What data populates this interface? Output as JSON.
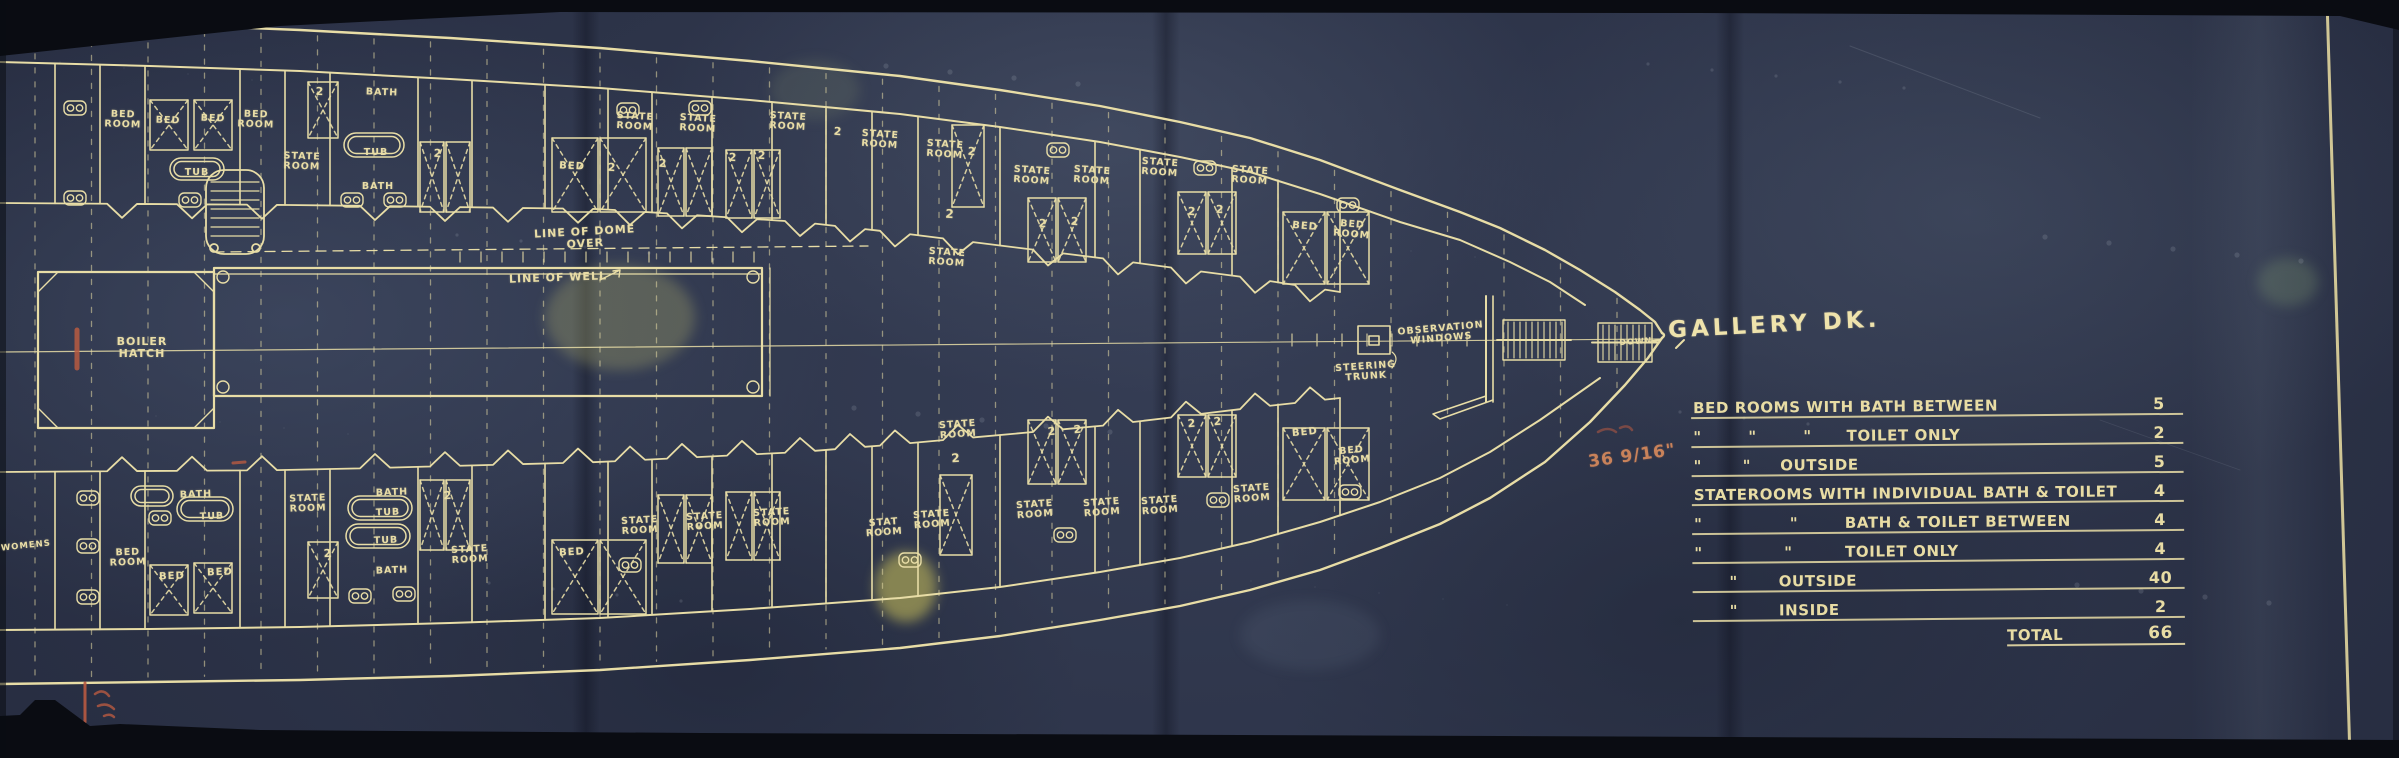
{
  "colors": {
    "paper": "#2d3448",
    "line": "#e8dda6",
    "red": "#b85a41",
    "frame": "#0a0c12"
  },
  "deck_title": {
    "text": "GALLERY DK."
  },
  "summary_table": {
    "rows": [
      {
        "label": "BED ROOMS WITH BATH BETWEEN",
        "value": "5"
      },
      {
        "label": "\"        \"        \"      TOILET ONLY",
        "value": "2"
      },
      {
        "label": "\"       \"     OUTSIDE",
        "value": "5"
      },
      {
        "label": "STATEROOMS WITH INDIVIDUAL BATH & TOILET",
        "value": "4"
      },
      {
        "label": "\"               \"        BATH & TOILET BETWEEN",
        "value": "4"
      },
      {
        "label": "\"              \"         TOILET ONLY",
        "value": "4"
      },
      {
        "label": "      \"       OUTSIDE",
        "value": "40"
      },
      {
        "label": "      \"       INSIDE",
        "value": "2"
      }
    ],
    "total": {
      "label": "TOTAL",
      "value": "66"
    }
  },
  "red_notes": {
    "dimension": "36 9/16\""
  },
  "plan_labels": [
    {
      "t": "BOILER\nHATCH",
      "x": 142,
      "y": 336,
      "s": 11,
      "r": 0
    },
    {
      "t": "LINE OF DOME OVER",
      "x": 585,
      "y": 226,
      "s": 11,
      "r": -3
    },
    {
      "t": "LINE OF WELL",
      "x": 558,
      "y": 272,
      "s": 11,
      "r": -2
    },
    {
      "t": "STEERING\nTRUNK",
      "x": 1366,
      "y": 362,
      "s": 9.5,
      "r": -4
    },
    {
      "t": "OBSERVATION\nWINDOWS",
      "x": 1441,
      "y": 324,
      "s": 9.5,
      "r": -5
    },
    {
      "t": "DOWN",
      "x": 1636,
      "y": 338,
      "s": 8,
      "r": -4
    },
    {
      "t": "WOMENS",
      "x": 26,
      "y": 542,
      "s": 8.5,
      "r": -6
    },
    {
      "t": "BED\nROOM",
      "x": 123,
      "y": 110,
      "s": 9.5,
      "r": 2
    },
    {
      "t": "BED",
      "x": 168,
      "y": 116,
      "s": 9.5,
      "r": 2
    },
    {
      "t": "BED",
      "x": 213,
      "y": 114,
      "s": 9.5,
      "r": 2
    },
    {
      "t": "BED\nROOM",
      "x": 256,
      "y": 110,
      "s": 9.5,
      "r": 2
    },
    {
      "t": "2",
      "x": 320,
      "y": 86,
      "s": 11,
      "r": 2
    },
    {
      "t": "BATH",
      "x": 382,
      "y": 88,
      "s": 9.5,
      "r": 2
    },
    {
      "t": "TUB",
      "x": 197,
      "y": 168,
      "s": 9.5,
      "r": 0
    },
    {
      "t": "STATE\nROOM",
      "x": 302,
      "y": 152,
      "s": 9.5,
      "r": 2
    },
    {
      "t": "TUB",
      "x": 376,
      "y": 148,
      "s": 9.5,
      "r": 0
    },
    {
      "t": "BATH",
      "x": 378,
      "y": 182,
      "s": 9.5,
      "r": 0
    },
    {
      "t": "2",
      "x": 438,
      "y": 148,
      "s": 11,
      "r": 3
    },
    {
      "t": "BED",
      "x": 572,
      "y": 162,
      "s": 10,
      "r": 3
    },
    {
      "t": "STATE\nROOM",
      "x": 635,
      "y": 112,
      "s": 9.5,
      "r": 3
    },
    {
      "t": "STATE\nROOM",
      "x": 698,
      "y": 114,
      "s": 9.5,
      "r": 3
    },
    {
      "t": "2",
      "x": 612,
      "y": 162,
      "s": 11,
      "r": 3
    },
    {
      "t": "2",
      "x": 663,
      "y": 158,
      "s": 11,
      "r": 3
    },
    {
      "t": "STATE\nROOM",
      "x": 788,
      "y": 112,
      "s": 9.5,
      "r": 3
    },
    {
      "t": "2",
      "x": 733,
      "y": 152,
      "s": 11,
      "r": 3
    },
    {
      "t": "2",
      "x": 762,
      "y": 150,
      "s": 11,
      "r": 3
    },
    {
      "t": "STATE\nROOM",
      "x": 880,
      "y": 130,
      "s": 9.5,
      "r": 4
    },
    {
      "t": "2",
      "x": 838,
      "y": 126,
      "s": 11,
      "r": 4
    },
    {
      "t": "STATE\nROOM",
      "x": 945,
      "y": 140,
      "s": 9.5,
      "r": 4
    },
    {
      "t": "2",
      "x": 972,
      "y": 146,
      "s": 11,
      "r": 4
    },
    {
      "t": "2",
      "x": 950,
      "y": 208,
      "s": 12,
      "r": 4
    },
    {
      "t": "STATE\nROOM",
      "x": 947,
      "y": 248,
      "s": 9.5,
      "r": 4
    },
    {
      "t": "STATE\nROOM",
      "x": 1032,
      "y": 166,
      "s": 9.5,
      "r": 4
    },
    {
      "t": "STATE\nROOM",
      "x": 1092,
      "y": 166,
      "s": 9.5,
      "r": 4
    },
    {
      "t": "2",
      "x": 1043,
      "y": 218,
      "s": 11,
      "r": 4
    },
    {
      "t": "2",
      "x": 1075,
      "y": 216,
      "s": 11,
      "r": 4
    },
    {
      "t": "STATE\nROOM",
      "x": 1160,
      "y": 158,
      "s": 9.5,
      "r": 4
    },
    {
      "t": "STATE\nROOM",
      "x": 1250,
      "y": 166,
      "s": 9.5,
      "r": 4
    },
    {
      "t": "2",
      "x": 1192,
      "y": 206,
      "s": 11,
      "r": 4
    },
    {
      "t": "2",
      "x": 1220,
      "y": 204,
      "s": 11,
      "r": 4
    },
    {
      "t": "BED",
      "x": 1305,
      "y": 222,
      "s": 10,
      "r": 5
    },
    {
      "t": "BED\nROOM",
      "x": 1352,
      "y": 220,
      "s": 9.5,
      "r": 5
    },
    {
      "t": "BATH",
      "x": 196,
      "y": 490,
      "s": 9.5,
      "r": -2
    },
    {
      "t": "TUB",
      "x": 212,
      "y": 512,
      "s": 9.5,
      "r": -2
    },
    {
      "t": "BED\nROOM",
      "x": 128,
      "y": 548,
      "s": 9.5,
      "r": -2
    },
    {
      "t": "BED",
      "x": 172,
      "y": 572,
      "s": 10,
      "r": -2
    },
    {
      "t": "BED",
      "x": 220,
      "y": 568,
      "s": 10,
      "r": -2
    },
    {
      "t": "STATE\nROOM",
      "x": 308,
      "y": 494,
      "s": 9.5,
      "r": -2
    },
    {
      "t": "2",
      "x": 328,
      "y": 548,
      "s": 11,
      "r": -2
    },
    {
      "t": "BATH",
      "x": 392,
      "y": 488,
      "s": 9.5,
      "r": -2
    },
    {
      "t": "TUB",
      "x": 388,
      "y": 508,
      "s": 9.5,
      "r": -2
    },
    {
      "t": "TUB",
      "x": 386,
      "y": 536,
      "s": 9.5,
      "r": -2
    },
    {
      "t": "BATH",
      "x": 392,
      "y": 566,
      "s": 9.5,
      "r": -2
    },
    {
      "t": "2",
      "x": 448,
      "y": 490,
      "s": 11,
      "r": -3
    },
    {
      "t": "STATE\nROOM",
      "x": 470,
      "y": 545,
      "s": 9.5,
      "r": -3
    },
    {
      "t": "BED",
      "x": 572,
      "y": 548,
      "s": 10,
      "r": -3
    },
    {
      "t": "STATE\nROOM",
      "x": 640,
      "y": 516,
      "s": 9.5,
      "r": -3
    },
    {
      "t": "STATE\nROOM",
      "x": 705,
      "y": 512,
      "s": 9.5,
      "r": -3
    },
    {
      "t": "STATE\nROOM",
      "x": 772,
      "y": 508,
      "s": 9.5,
      "r": -3
    },
    {
      "t": "STAT\nROOM",
      "x": 884,
      "y": 518,
      "s": 9.5,
      "r": -4
    },
    {
      "t": "STATE\nROOM",
      "x": 932,
      "y": 510,
      "s": 9.5,
      "r": -4
    },
    {
      "t": "2",
      "x": 956,
      "y": 452,
      "s": 12,
      "r": -4
    },
    {
      "t": "STATE\nROOM",
      "x": 958,
      "y": 420,
      "s": 9.5,
      "r": -4
    },
    {
      "t": "STATE\nROOM",
      "x": 1035,
      "y": 500,
      "s": 9.5,
      "r": -4
    },
    {
      "t": "STATE\nROOM",
      "x": 1102,
      "y": 498,
      "s": 9.5,
      "r": -4
    },
    {
      "t": "2",
      "x": 1052,
      "y": 426,
      "s": 11,
      "r": -4
    },
    {
      "t": "2",
      "x": 1078,
      "y": 424,
      "s": 11,
      "r": -4
    },
    {
      "t": "STATE\nROOM",
      "x": 1160,
      "y": 496,
      "s": 9.5,
      "r": -4
    },
    {
      "t": "STATE\nROOM",
      "x": 1252,
      "y": 484,
      "s": 9.5,
      "r": -4
    },
    {
      "t": "2",
      "x": 1192,
      "y": 418,
      "s": 11,
      "r": -4
    },
    {
      "t": "2",
      "x": 1218,
      "y": 416,
      "s": 11,
      "r": -4
    },
    {
      "t": "BED",
      "x": 1305,
      "y": 428,
      "s": 10,
      "r": -5
    },
    {
      "t": "BED\nROOM",
      "x": 1352,
      "y": 446,
      "s": 9.5,
      "r": -5
    }
  ]
}
